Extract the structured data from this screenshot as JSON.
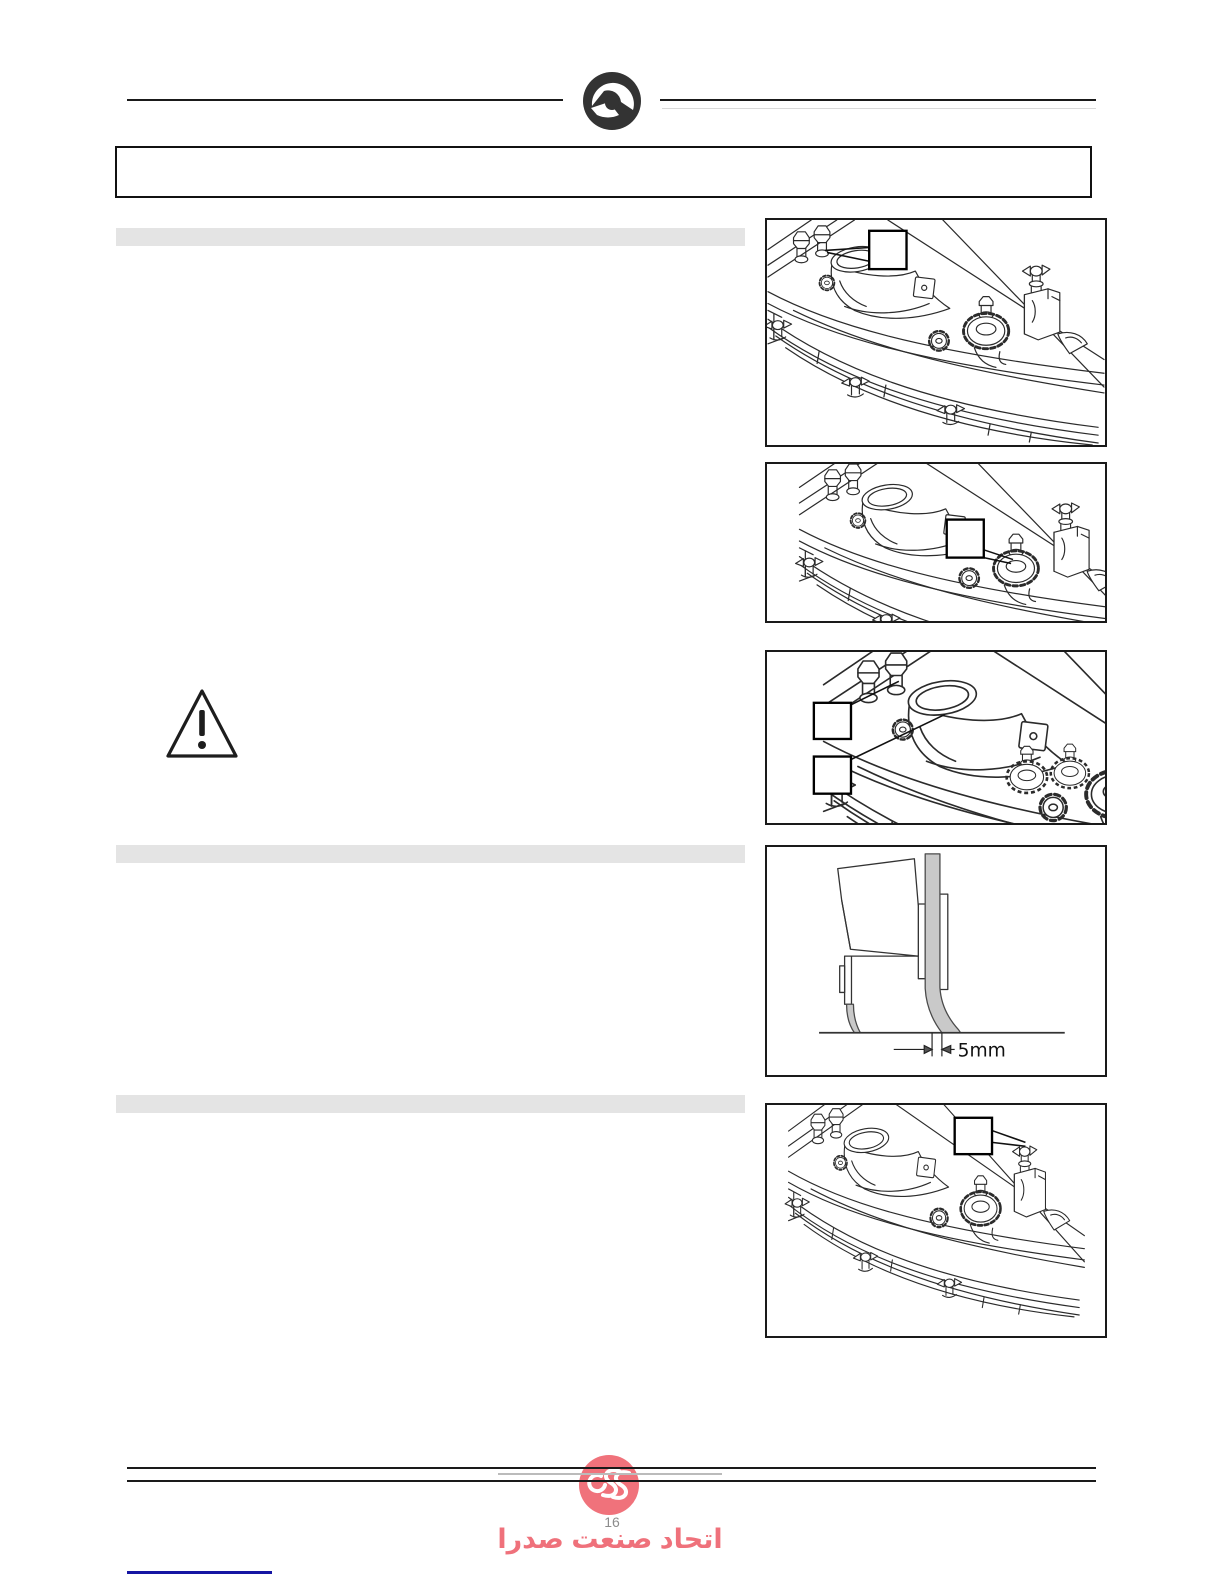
{
  "header": {
    "logo_icon": "comac-brand-mark",
    "title_box_text": ""
  },
  "sections": [
    {
      "heading": ""
    },
    {
      "heading": ""
    },
    {
      "heading": ""
    }
  ],
  "warning": {
    "icon": "warning-triangle"
  },
  "figures": {
    "fig1": {
      "content": "squeegee assembly top view",
      "callout_label": ""
    },
    "fig2": {
      "content": "squeegee assembly knob view",
      "callout_label": ""
    },
    "fig3": {
      "content": "squeegee close-up",
      "callout_labels": [
        "",
        ""
      ]
    },
    "fig4": {
      "content": "squeegee blade deflection diagram",
      "dimension_label": "5mm"
    },
    "fig5": {
      "content": "squeegee assembly bracket view",
      "callout_label": ""
    }
  },
  "footer": {
    "brand_logo_text": "ESS",
    "brand_name_fa": "اتحاد صنعت صدرا",
    "page_number": "16",
    "colors": {
      "watermark": "#ee5f69",
      "page_number": "#8c8c8c",
      "link_line": "#1515a3"
    }
  }
}
